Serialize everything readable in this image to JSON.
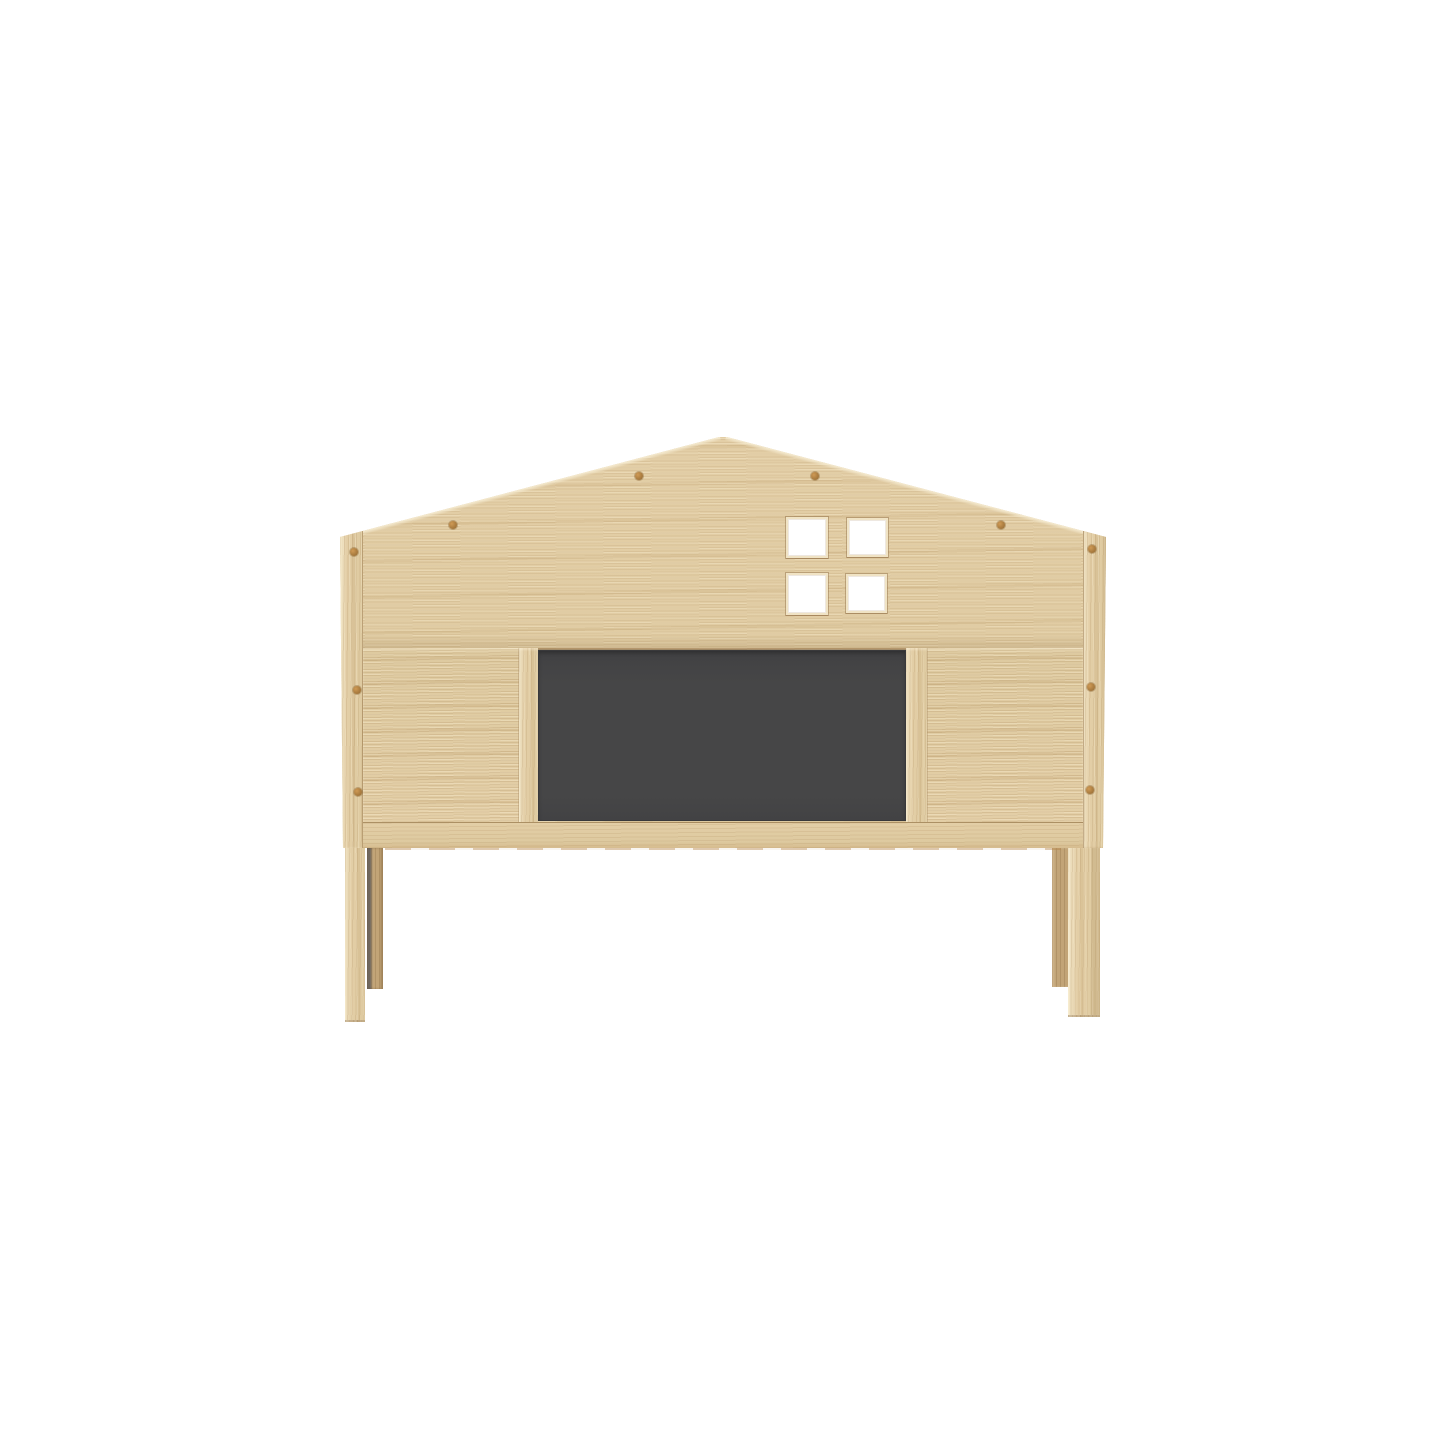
{
  "background": "#ffffff",
  "scene": {
    "description": "Product render of a house-shaped light-oak kids bed headboard with a four-pane window cutout, central dark chalkboard panel, screw caps and four legs on a plain white background"
  },
  "colors": {
    "background": "#ffffff",
    "wood-base": "#e3cea6",
    "wood-panel": "#decaa0",
    "wood-light": "#f0e3c4",
    "roof-highlight": "#f6ecd2",
    "chalkboard": "#464647",
    "chalkboard-edge": "#39393b",
    "screw": "#cf9a55",
    "screw-dark": "#8f6630",
    "leg-back": "#c2a477",
    "leg-shadow": "#6f675e"
  },
  "counts": {
    "window_panes": 4,
    "screw_caps_roof": 4,
    "screw_caps_sides": 6,
    "legs": 4
  }
}
